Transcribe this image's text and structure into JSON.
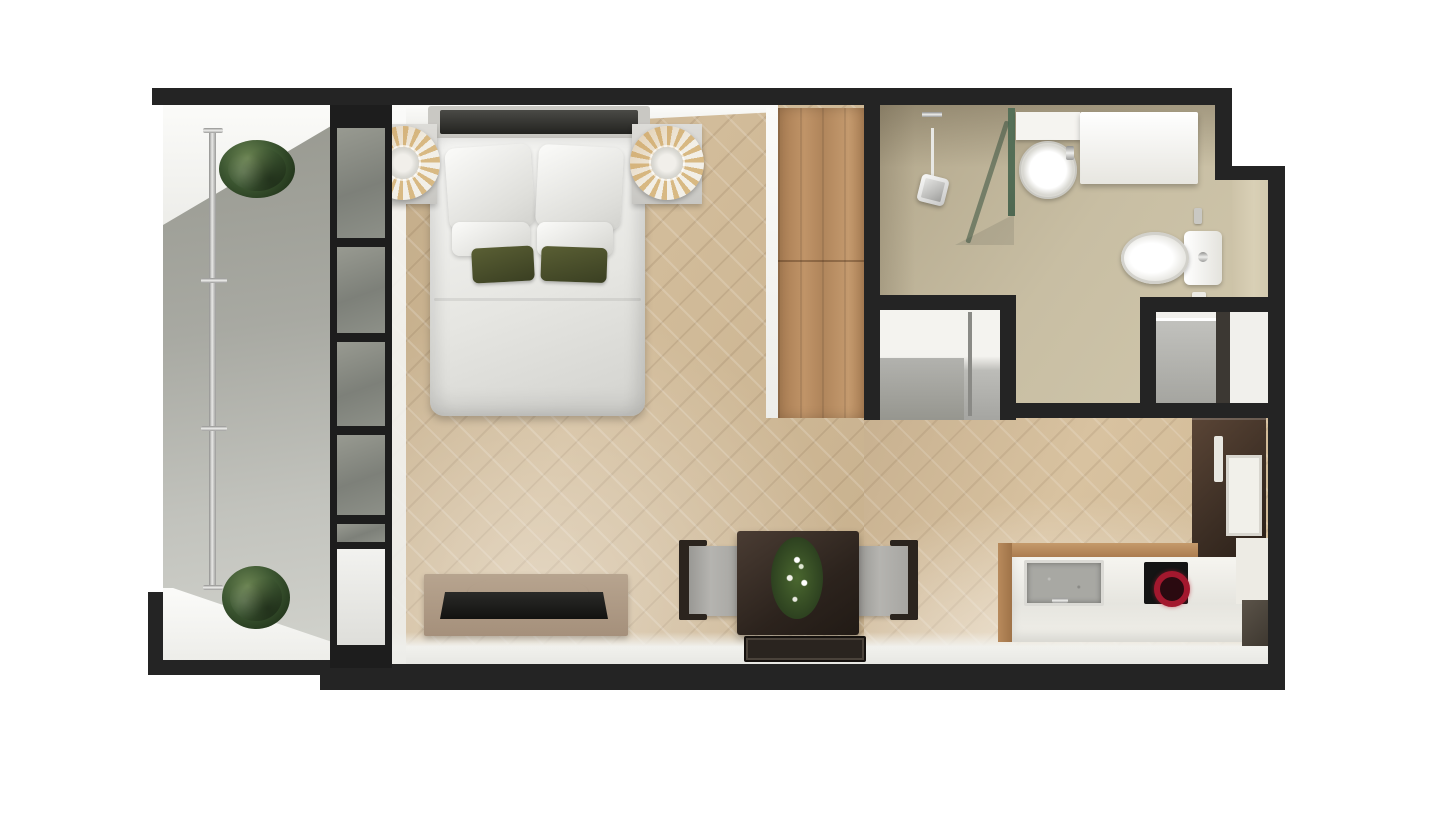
{
  "scene": {
    "kind": "floorplan-3d-top-view",
    "description": "Top-down 3D render of a studio apartment floor plan with balcony, combined bedroom-living room, wardrobe, bathroom, closets and kitchenette",
    "rooms": [
      {
        "name": "balcony",
        "floor": "concrete"
      },
      {
        "name": "bedroom-living-room",
        "floor": "herringbone-wood"
      },
      {
        "name": "bathroom",
        "floor": "beige-tile"
      },
      {
        "name": "closet-left",
        "floor": "gray"
      },
      {
        "name": "closet-right",
        "floor": "gray"
      },
      {
        "name": "kitchenette",
        "floor": "herringbone-wood"
      }
    ],
    "furniture": [
      "double-bed",
      "nightstand-left",
      "nightstand-right",
      "fan-lamp-left",
      "fan-lamp-right",
      "tv-console",
      "tv",
      "dining-table",
      "dining-chair-left",
      "dining-chair-right",
      "table-plant",
      "floor-mat",
      "wardrobe",
      "shower",
      "hand-shower",
      "shower-glass",
      "washbasin",
      "vanity-counter",
      "toilet",
      "kitchen-counter",
      "kitchen-sink",
      "induction-hob",
      "tall-cabinet-fridge",
      "balcony-plant-top",
      "balcony-plant-bottom",
      "balcony-railing",
      "glazed-window-wall"
    ]
  },
  "palette": {
    "wall": "#242424",
    "wood": "#cdb695",
    "concrete": "#a6a7a1",
    "bath_floor": "#c3b89d",
    "inner_face": "#f2f2ee",
    "wardrobe_wood": "#b98c60",
    "glass": "#8b908b",
    "plant_green": "#3c5631",
    "bed_white": "#efefec",
    "pillow_green": "#4b5130",
    "lamp_tan": "#d8b983",
    "lamp_cream": "#f2efe7",
    "nightstand": "#d3d2ce",
    "table_dark": "#2e251f",
    "chair_gray": "#a3a29e",
    "console_taupe": "#b09d89",
    "tv_black": "#1b1b19",
    "chrome": "#d9d9d7",
    "counter_white": "#f0efe9",
    "counter_wood": "#b78a5c",
    "sink_gray": "#a8a8a3",
    "hob_red": "#a51a2e",
    "cabinet_brown": "#433328",
    "closet_gray": "#b0b0ac",
    "toilet_white": "#f4f3ef"
  }
}
